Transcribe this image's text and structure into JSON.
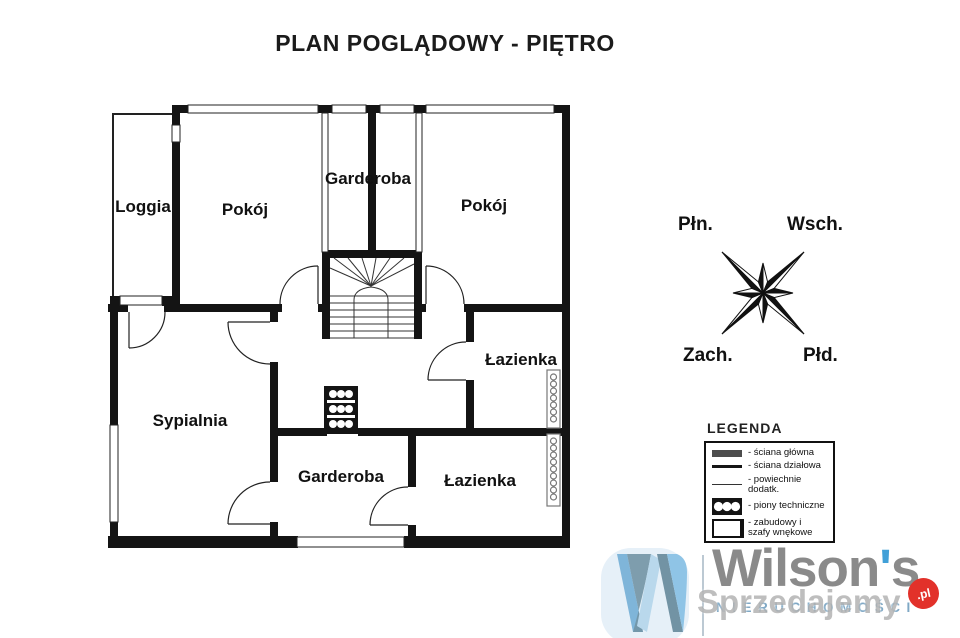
{
  "title": "PLAN POGLĄDOWY - PIĘTRO",
  "plan": {
    "rooms": [
      {
        "label": "Loggia"
      },
      {
        "label": "Pokój"
      },
      {
        "label": "Garderoba"
      },
      {
        "label": "Pokój"
      },
      {
        "label": "Sypialnia"
      },
      {
        "label": "Łazienka"
      },
      {
        "label": "Garderoba"
      },
      {
        "label": "Łazienka"
      }
    ]
  },
  "compass": {
    "north": "Płn.",
    "east": "Wsch.",
    "west": "Zach.",
    "south": "Płd."
  },
  "legend": {
    "title": "LEGENDA",
    "items": [
      {
        "symbol": "main-wall",
        "label": "- ściana główna"
      },
      {
        "symbol": "partition-wall",
        "label": "- ściana działowa"
      },
      {
        "symbol": "additional-area-line",
        "label": "- powiechnie dodatk."
      },
      {
        "symbol": "technical-shaft",
        "label": "- piony techniczne"
      },
      {
        "symbol": "built-in-wardrobe",
        "label": "- zabudowy i szafy wnękowe"
      }
    ]
  },
  "logo": {
    "brand_prefix": "Wilson",
    "apostrophe": "'",
    "brand_suffix": "s",
    "subtitle": "NIERUCHOMOŚCI",
    "watermark": "Sprzedajemy",
    "watermark_badge": ".pl",
    "colors": {
      "brand_gray": "#8a8a8a",
      "brand_blue": "#7fa8c5",
      "apostrophe_blue": "#41a0d8",
      "badge_red": "#e2312a",
      "icon_light_blue": "#8fc4e6",
      "icon_gray_blue": "#7293a4"
    }
  }
}
